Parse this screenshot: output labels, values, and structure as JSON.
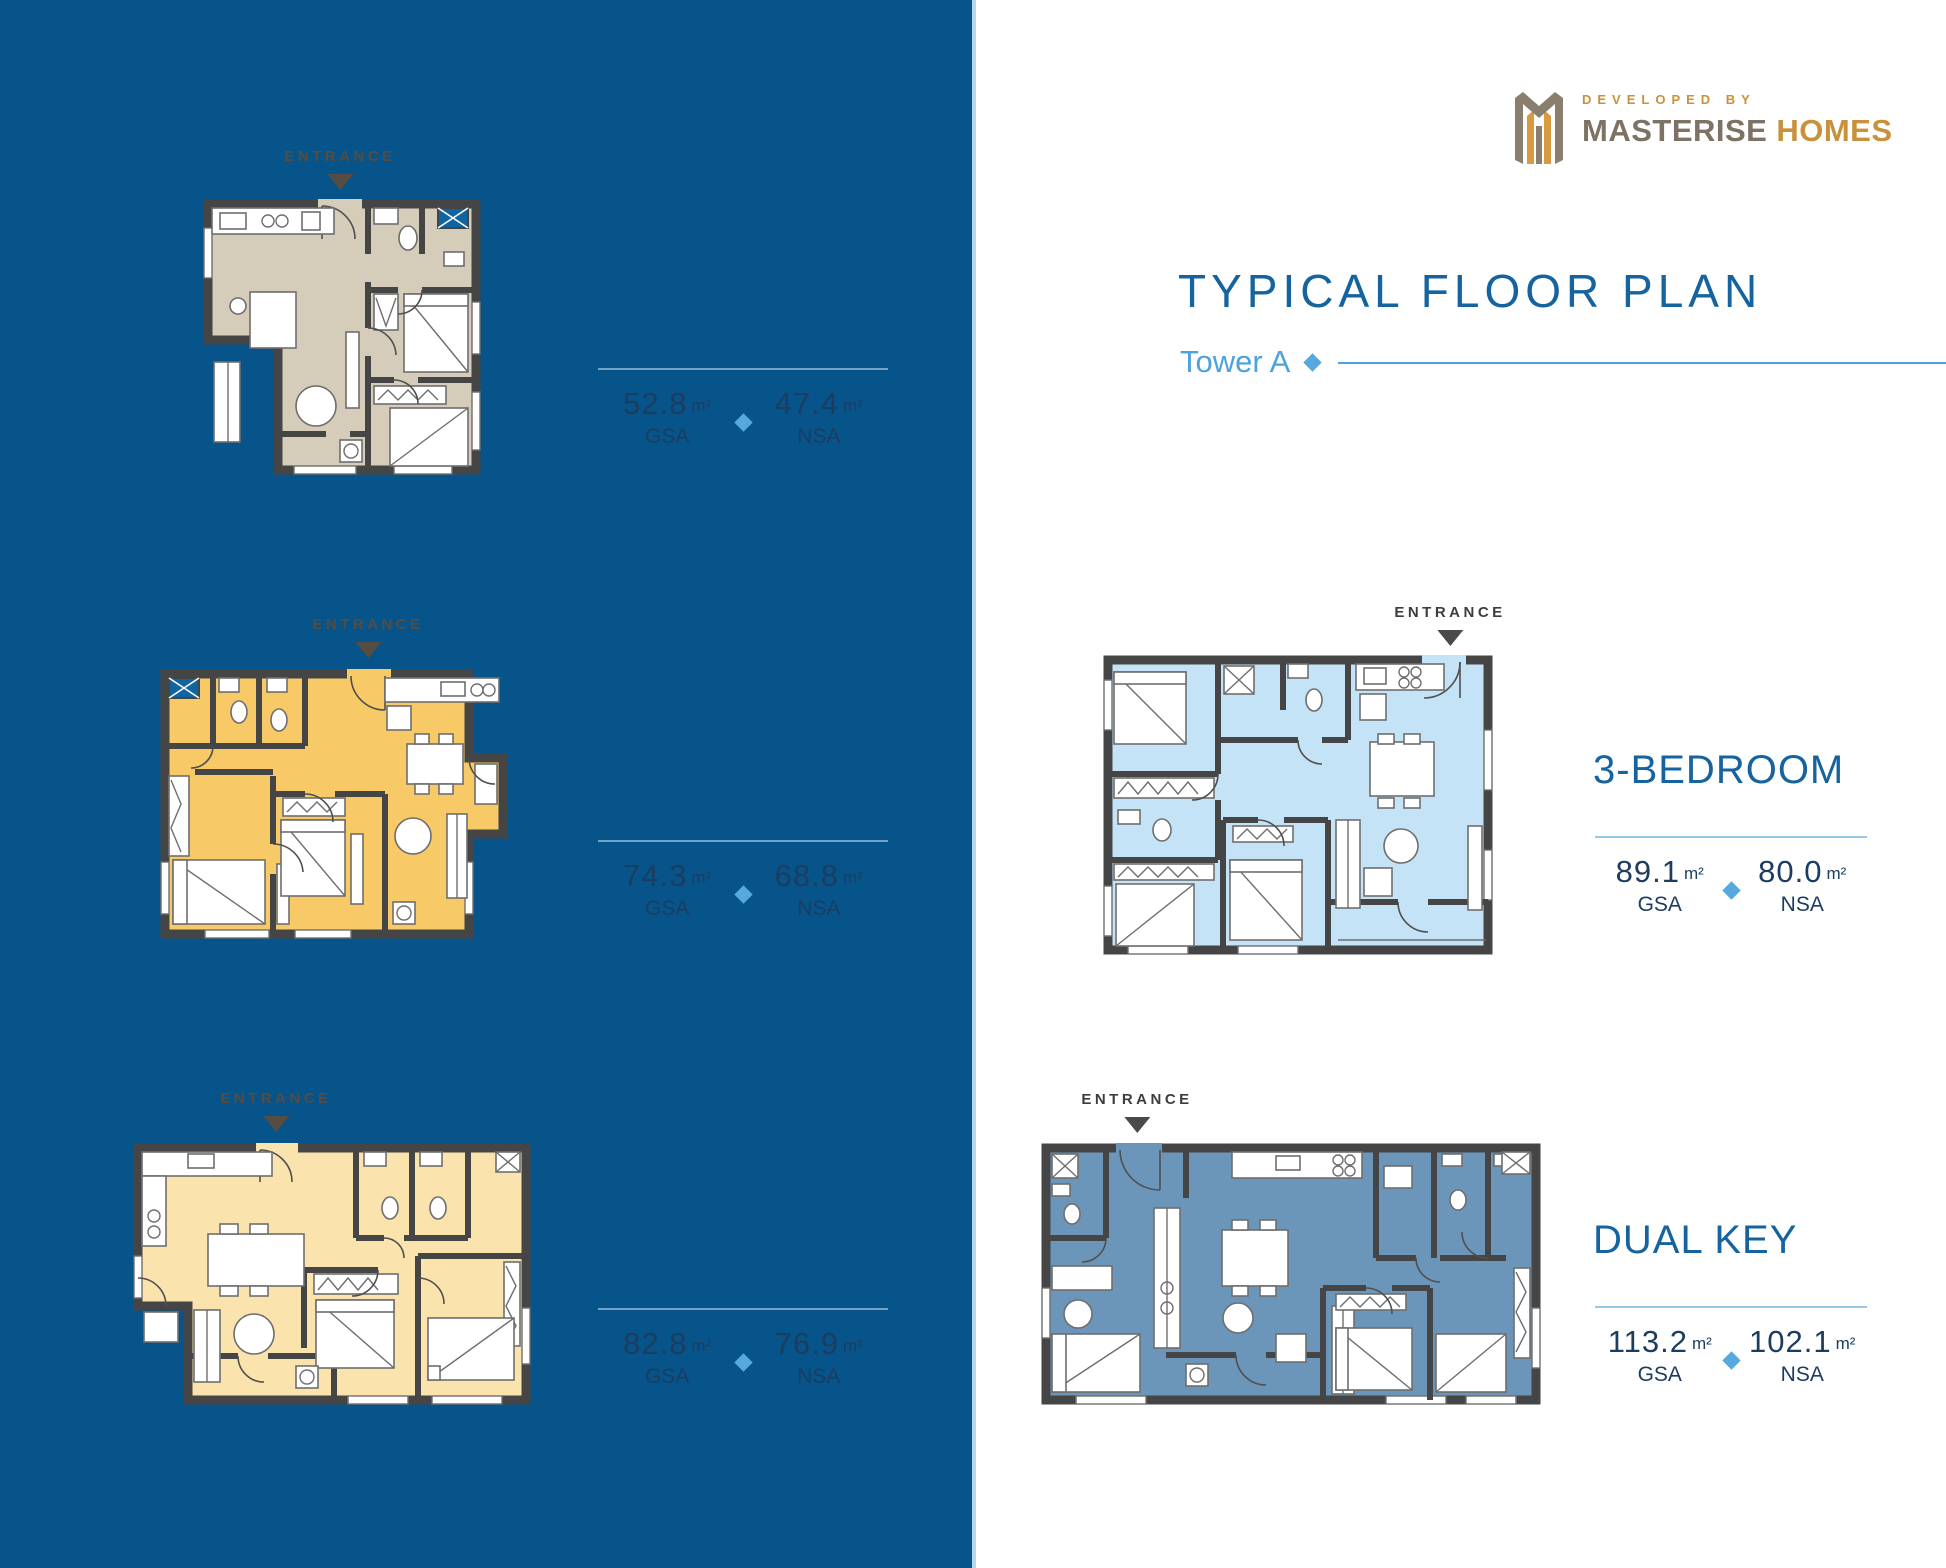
{
  "brand": {
    "developed_by": "DEVELOPED BY",
    "name_primary": "MASTERISE",
    "name_secondary": "HOMES"
  },
  "header": {
    "title": "TYPICAL FLOOR PLAN",
    "subtitle": "Tower A"
  },
  "labels": {
    "entrance": "ENTRANCE",
    "gsa": "GSA",
    "nsa": "NSA",
    "unit": "m²"
  },
  "plans": {
    "left": [
      {
        "gsa": "52.8",
        "nsa": "47.4"
      },
      {
        "gsa": "74.3",
        "nsa": "68.8"
      },
      {
        "gsa": "82.8",
        "nsa": "76.9"
      }
    ],
    "right": [
      {
        "name": "3-BEDROOM",
        "gsa": "89.1",
        "nsa": "80.0"
      },
      {
        "name": "DUAL KEY",
        "gsa": "113.2",
        "nsa": "102.1"
      }
    ]
  },
  "colors": {
    "panel_background": "#07548A",
    "accent_blue": "#4CA2DB",
    "diamond_blue": "#56A8DF",
    "heading_blue": "#15639F",
    "measurement_text": "#1C3D60",
    "divider_on_panel": "#6FA3C7",
    "divider_on_white": "#98C8E8",
    "entrance_on_panel": "#564C41",
    "entrance_on_white": "#3D3D3D",
    "logo_gold": "#C8913C",
    "logo_taupe": "#7D7263",
    "plan_fill_1": "#D6CCBA",
    "plan_fill_2": "#F8C967",
    "plan_fill_3": "#FBE3AD",
    "plan_fill_3bedroom": "#C5E3F6",
    "plan_fill_dualkey": "#6B96BA",
    "wall": "#454545"
  }
}
